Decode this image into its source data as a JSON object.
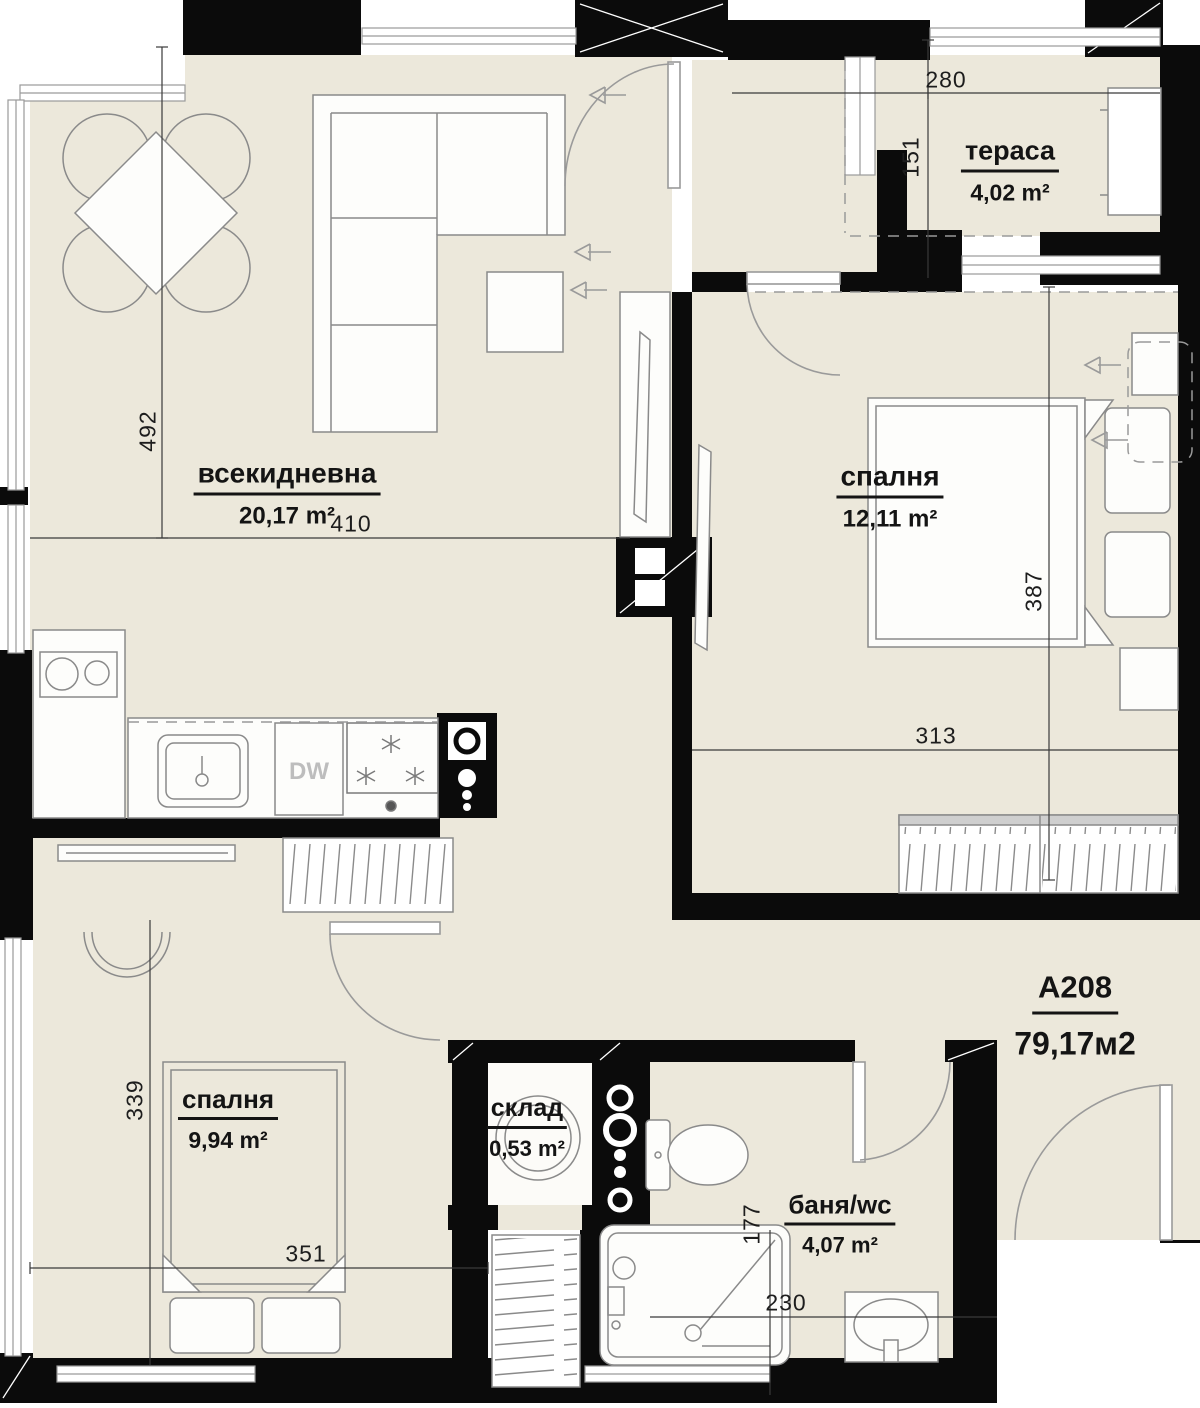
{
  "plan": {
    "apartment": {
      "id": "A208",
      "area": "79,17м2"
    },
    "rooms": {
      "living": {
        "name": "всекидневна",
        "area": "20,17 m²"
      },
      "bedroom1": {
        "name": "спалня",
        "area": "12,11 m²"
      },
      "bedroom2": {
        "name": "спалня",
        "area": "9,94 m²"
      },
      "terrace": {
        "name": "тераса",
        "area": "4,02 m²"
      },
      "storage": {
        "name": "склад",
        "area": "0,53 m²"
      },
      "bath": {
        "name": "баня/wc",
        "area": "4,07 m²"
      }
    },
    "dimensions": {
      "d492": "492",
      "d410": "410",
      "d280": "280",
      "d151": "151",
      "d387": "387",
      "d313": "313",
      "d339": "339",
      "d351": "351",
      "d177": "177",
      "d230": "230"
    },
    "labels": {
      "dishwasher": "DW"
    },
    "colors": {
      "floor": "#ece8db",
      "wall": "#0b0b0b",
      "furniture_outline": "#8a8a8a",
      "dimension_text": "#1d1d1d",
      "dw_text": "#bdbdbd",
      "outside": "#ffffff"
    }
  }
}
